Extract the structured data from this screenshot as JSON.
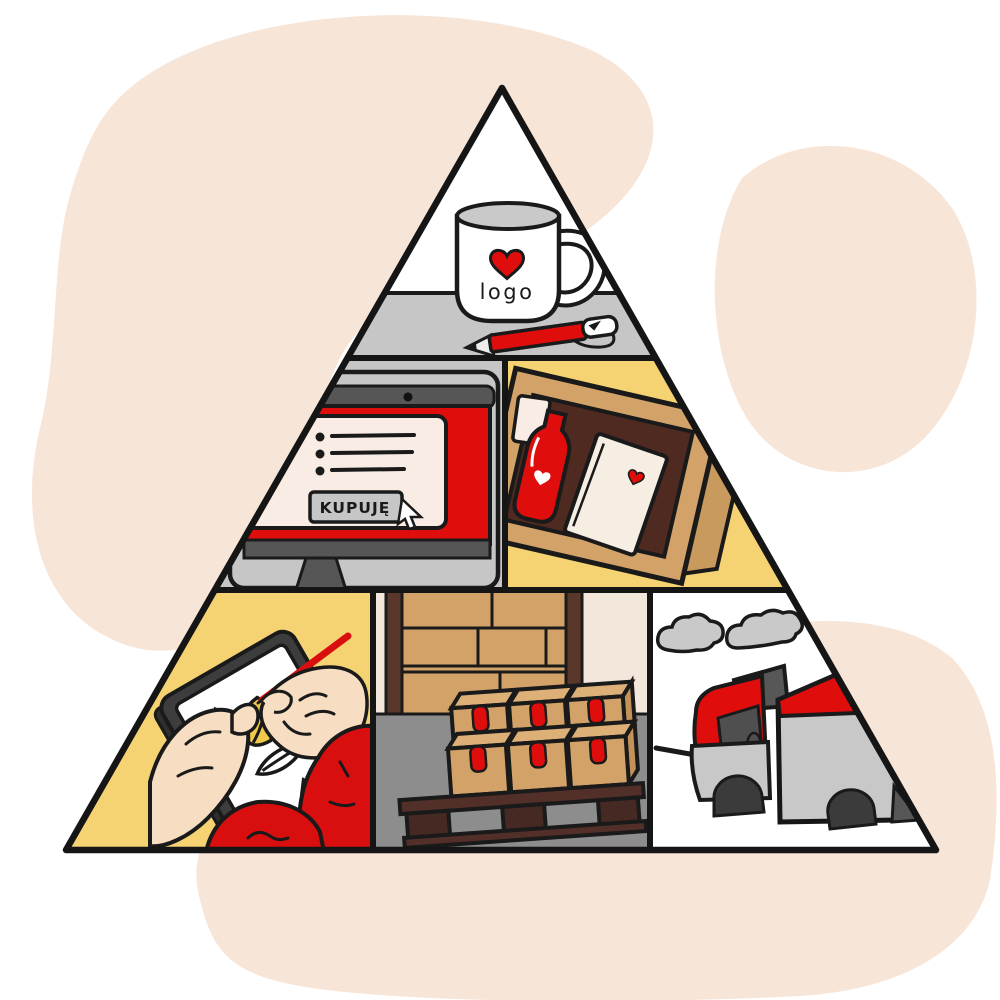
{
  "illustration": {
    "name": "brand-merchandise-pyramid",
    "labels": {
      "mug": "logo",
      "buy_button": "KUPUJĘ"
    },
    "colors": {
      "blob": "#f7e5d8",
      "yellow": "#f5d272",
      "red": "#e00d0d",
      "light_gray": "#c6c6c6",
      "dark_gray": "#575757",
      "tan": "#d2a268",
      "tan_light": "#ddb078",
      "dark_brown": "#4e2a21",
      "cream": "#f8ece4",
      "floor_gray": "#8d8d8d",
      "skin": "#f7ddc2",
      "outline": "#1a1a1a",
      "white": "#ffffff"
    },
    "sections": [
      {
        "name": "branded-mug-and-pen"
      },
      {
        "name": "online-shop-buy-screen"
      },
      {
        "name": "branded-gift-box"
      },
      {
        "name": "designer-drawing-tablet"
      },
      {
        "name": "warehouse-pallet-boxes"
      },
      {
        "name": "delivery-truck"
      }
    ]
  }
}
